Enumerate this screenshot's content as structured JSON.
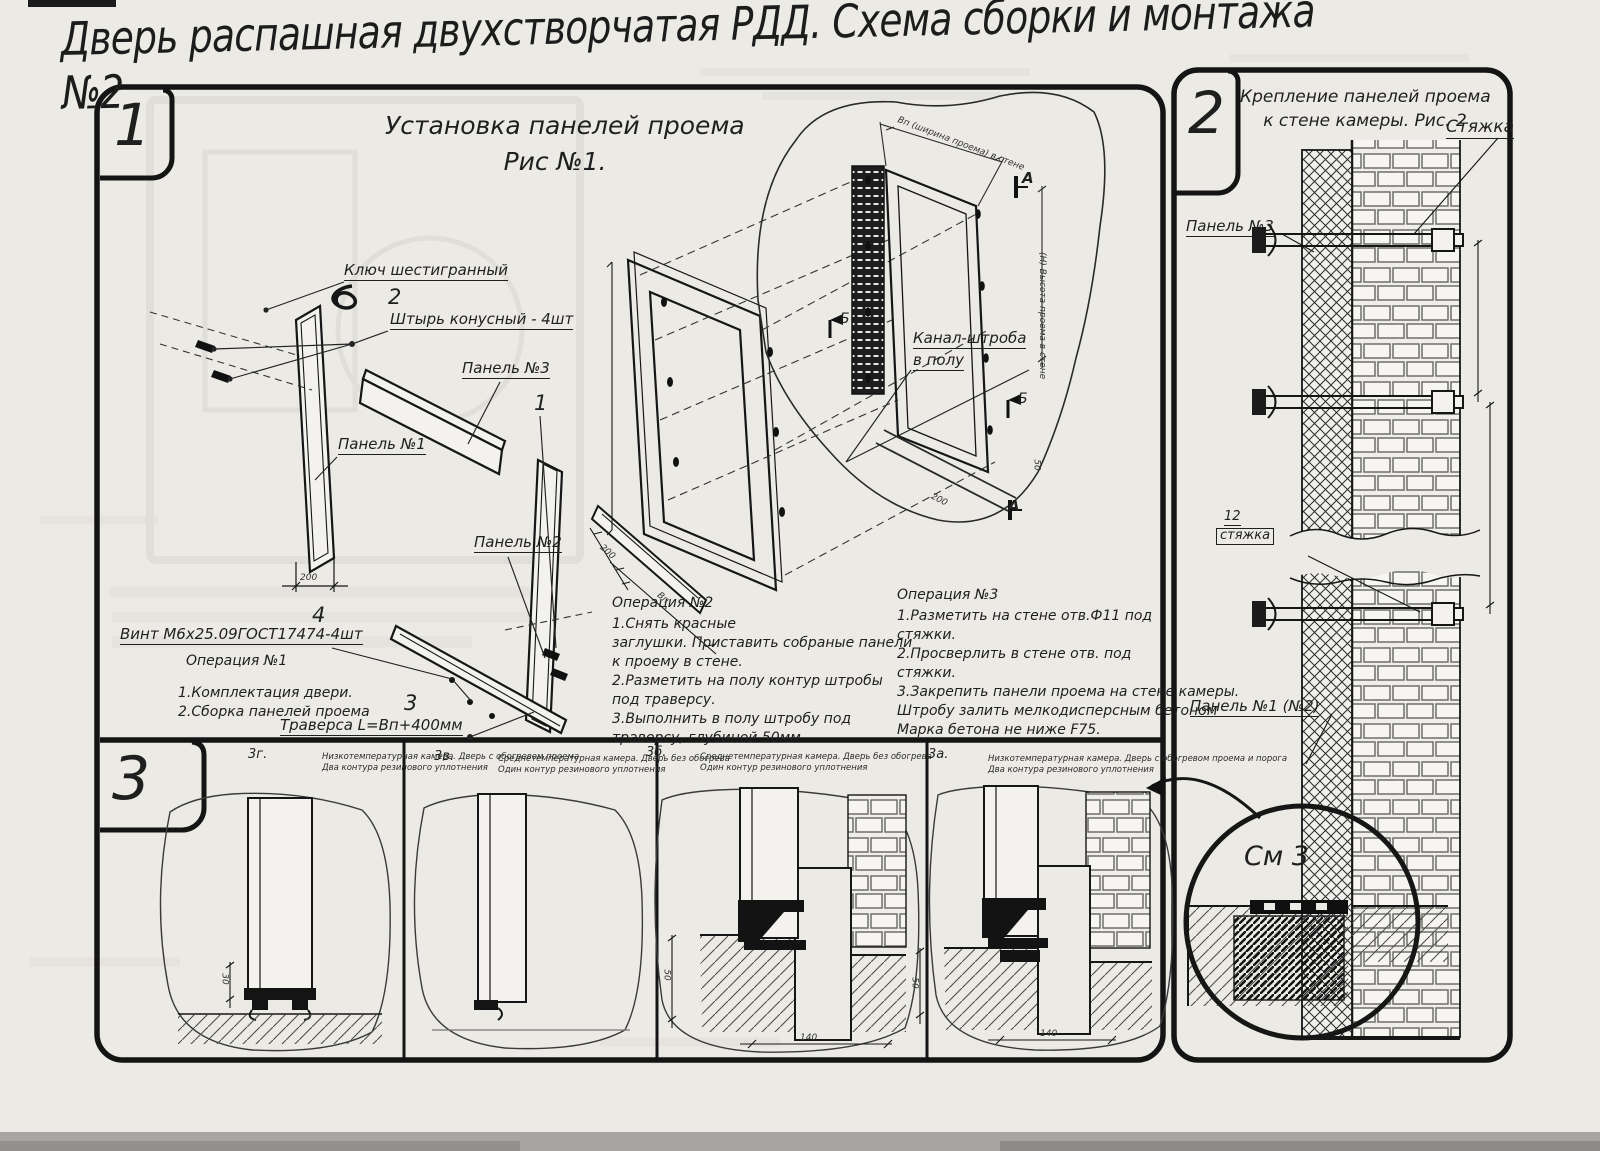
{
  "title": "Дверь распашная двухстворчатая РДД.  Схема сборки и монтажа №2",
  "panel1": {
    "badge": "1",
    "heading": [
      "Установка панелей проема",
      "Рис №1."
    ],
    "labels": {
      "hex_key": "Ключ шестигранный",
      "pin_num": "2",
      "pin": "Штырь конусный - 4шт",
      "panel3": "Панель №3",
      "callout1": "1",
      "panel1": "Панель №1",
      "panel2": "Панель №2",
      "screw_num": "4",
      "screw": "Винт М6х25.09ГОСТ17474-4шт",
      "traverse_num": "3",
      "traverse": "Траверса  L=Bп+400мм",
      "channel_line1": "Канал-штроба",
      "channel_line2": "в полу",
      "view_a": "А",
      "view_b": "Б",
      "dim_200": "200",
      "dim_50": "50",
      "dim_bp": "Вп",
      "dim_bp_top": "Вп (ширина проема) в стене",
      "dim_h_right": "(Н) Высота проема в стене"
    },
    "op1": {
      "title": "Операция №1",
      "lines": [
        "1.Комплектация двери.",
        "2.Сборка панелей проема"
      ]
    },
    "op2": {
      "title": "Операция №2",
      "lines": [
        "1.Снять красные",
        "заглушки. Приставить собраные панели",
        "к проему в стене.",
        "2.Разметить на полу контур штробы",
        "под траверсу.",
        "3.Выполнить в полу штробу под",
        "траверсу, глубиной 50мм."
      ]
    },
    "op3": {
      "title": "Операция №3",
      "lines": [
        "1.Разметить на стене отв.Ф11 под",
        "стяжки.",
        "2.Просверлить в стене отв.  под",
        "стяжки.",
        "3.Закрепить панели проема на стене камеры.",
        "Штробу залить мелкодисперсным бетоном",
        "Марка бетона не ниже  F75."
      ]
    }
  },
  "panel2": {
    "badge": "2",
    "heading": [
      "Крепление панелей проема",
      "к стене камеры. Рис. 2"
    ],
    "labels": {
      "tie": "Стяжка",
      "panel3": "Панель №3",
      "tie_num": "12",
      "tie_small": "стяжка",
      "panel12": "Панель №1 (№2)",
      "see3": "См 3"
    }
  },
  "panel3": {
    "badge": "3",
    "details": [
      {
        "id": "3г.",
        "caption": [
          "Низкотемпературная камера. Дверь с обогревом проема",
          "Два контура резинового уплотнения"
        ]
      },
      {
        "id": "3в.",
        "caption": [
          "Среднетемпературная камера. Дверь без обогрева",
          "Один контур резинового уплотнения"
        ]
      },
      {
        "id": "3б.",
        "caption": [
          "Среднетемпературная камера. Дверь без обогрева",
          "Один контур резинового уплотнения"
        ]
      },
      {
        "id": "3а.",
        "caption": [
          "Низкотемпературная камера. Дверь с обогревом проема и порога",
          "Два контура резинового уплотнения"
        ]
      }
    ],
    "dims": {
      "d30": "30",
      "d50": "50",
      "d140": "140"
    }
  },
  "colors": {
    "ink": "#1c1c1c",
    "paper": "#eceae5"
  }
}
